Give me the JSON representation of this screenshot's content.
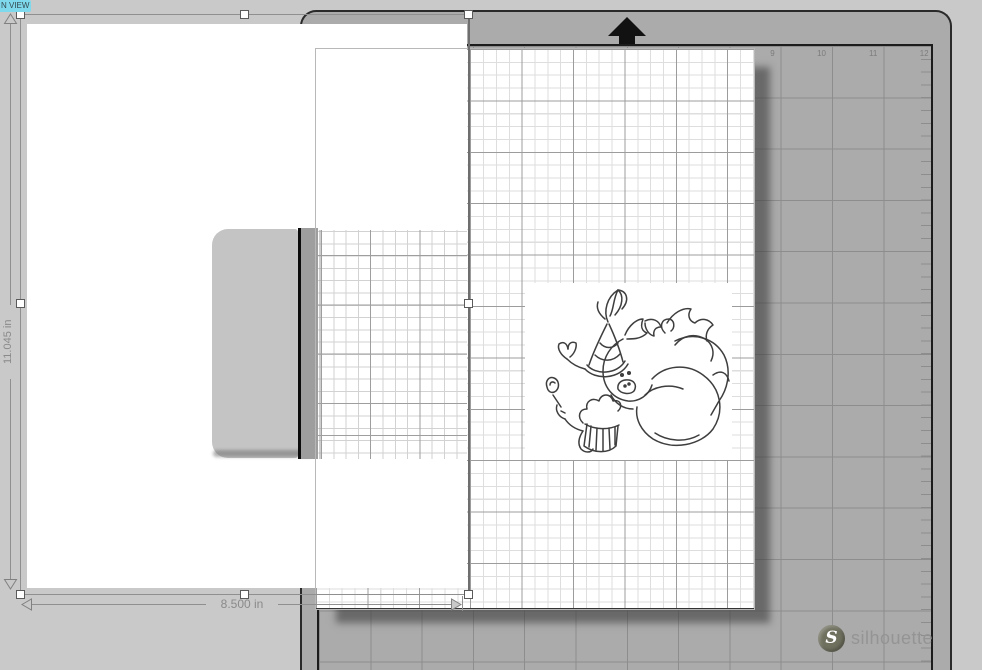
{
  "view_badge": {
    "label": "N VIEW"
  },
  "selection": {
    "width_label": "8.500 in",
    "height_label": "11.045 in"
  },
  "mat": {
    "ruler_numbers": {
      "n9": "9",
      "n10": "10",
      "n11": "11",
      "n12": "12"
    },
    "brand_text": "silhouette",
    "logo_letter": "S"
  },
  "objects": {
    "placed_image": "cartoon pig wearing party hat holding cupcake (rotated line art)",
    "scanned_page": "white scanned page with graph-paper notepad"
  },
  "colors": {
    "background": "#c9c9c9",
    "mat": "#ababab",
    "badge_bg": "#7fd9ec",
    "dimension_text": "#8a8a8a",
    "mat_grid_line": "#8d8d8d"
  }
}
